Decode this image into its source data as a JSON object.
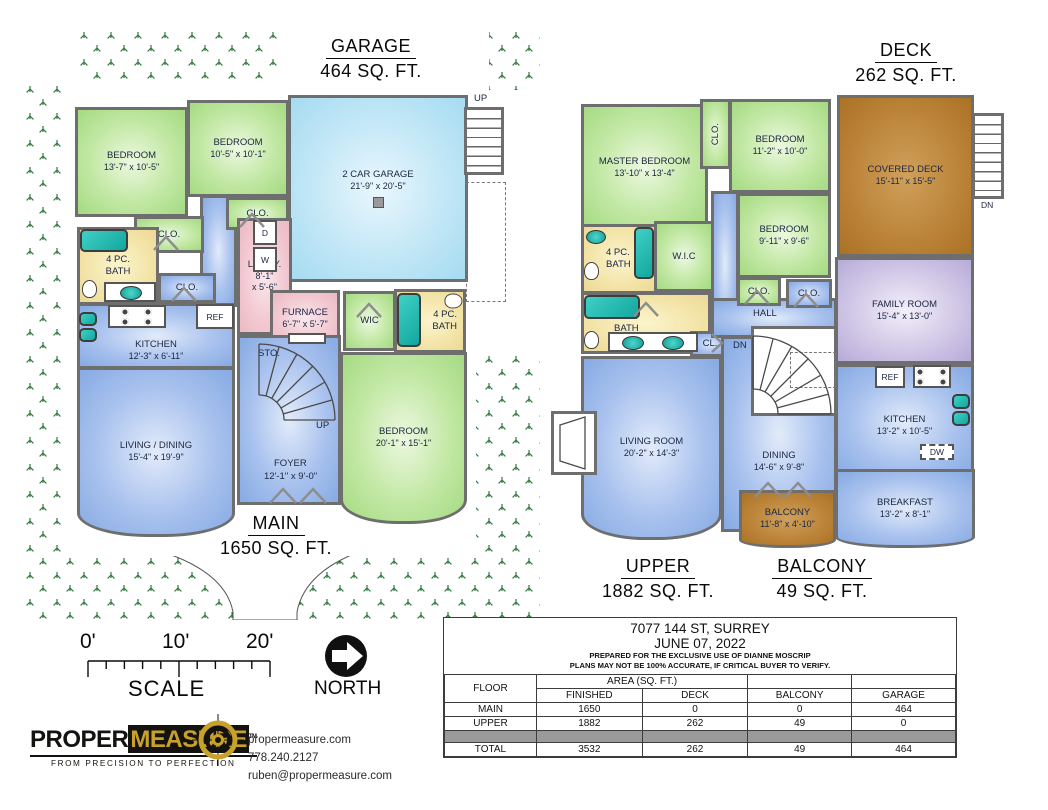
{
  "main_plan": {
    "garage_title": {
      "l1": "GARAGE",
      "l2": "464 SQ. FT."
    },
    "floor_label": {
      "l1": "MAIN",
      "l2": "1650 SQ. FT."
    },
    "rooms": {
      "bedroom1": {
        "name": "BEDROOM",
        "dims": "13'-7\" x 10'-5\""
      },
      "bedroom2": {
        "name": "BEDROOM",
        "dims": "10'-5\" x 10'-1\""
      },
      "garage": {
        "name": "2 CAR GARAGE",
        "dims": "21'-9\" x 20'-5\""
      },
      "kitchen": {
        "name": "KITCHEN",
        "dims": "12'-3\" x 6'-11\""
      },
      "living": {
        "name": "LIVING / DINING",
        "dims": "15'-4\" x 19'-9\""
      },
      "lndry": {
        "name": "LNDRY.",
        "d1": "8'-1\"",
        "d2": "x 5'-6\""
      },
      "furnace": {
        "name": "FURNACE",
        "dims": "6'-7\" x 5'-7\""
      },
      "foyer": {
        "name": "FOYER",
        "dims": "12'-1\" x 9'-0\""
      },
      "bedroom3": {
        "name": "BEDROOM",
        "dims": "20'-1\" x 15'-1\""
      },
      "bath": {
        "l1": "4 PC.",
        "l2": "BATH"
      },
      "clo": "CLO.",
      "wic": "WIC",
      "sto": "STO.",
      "up": "UP",
      "ref": "REF",
      "d": "D",
      "w": "W"
    }
  },
  "upper_plan": {
    "deck_title": {
      "l1": "DECK",
      "l2": "262 SQ. FT."
    },
    "floor_label": {
      "l1": "UPPER",
      "l2": "1882 SQ. FT."
    },
    "balcony_label": {
      "l1": "BALCONY",
      "l2": "49 SQ. FT."
    },
    "rooms": {
      "master": {
        "name": "MASTER BEDROOM",
        "dims": "13'-10\" x 13'-4\""
      },
      "bedroom4": {
        "name": "BEDROOM",
        "dims": "11'-2\" x 10'-0\""
      },
      "bedroom5": {
        "name": "BEDROOM",
        "dims": "9'-11\" x 9'-6\""
      },
      "covered_deck": {
        "name": "COVERED DECK",
        "dims": "15'-11\" x 15'-5\""
      },
      "family": {
        "name": "FAMILY ROOM",
        "dims": "15'-4\" x 13'-0\""
      },
      "kitchen": {
        "name": "KITCHEN",
        "dims": "13'-2\" x 10'-5\""
      },
      "breakfast": {
        "name": "BREAKFAST",
        "dims": "13'-2\" x 8'-1\""
      },
      "living": {
        "name": "LIVING ROOM",
        "dims": "20'-2\" x 14'-3\""
      },
      "dining": {
        "name": "DINING",
        "dims": "14'-6\" x 9'-8\""
      },
      "balcony": {
        "name": "BALCONY",
        "dims": "11'-8\" x 4'-10\""
      },
      "bath4": {
        "l1": "4 PC.",
        "l2": "BATH"
      },
      "bath5": {
        "l1": "5 PC.",
        "l2": "BATH"
      },
      "wic": "W.I.C",
      "hall": "HALL",
      "cl": "CL.",
      "clo": "CLO.",
      "dn": "DN",
      "ref": "REF",
      "dw": "DW"
    }
  },
  "scale_bar": {
    "t0": "0'",
    "t10": "10'",
    "t20": "20'",
    "label": "SCALE"
  },
  "north": {
    "label": "NORTH"
  },
  "logo": {
    "word1": "PROPER",
    "word2": "MEASURE",
    "tm": "TM",
    "tagline": "FROM PRECISION TO PERFECTION"
  },
  "contact": {
    "website": "propermeasure.com",
    "phone": "778.240.2127",
    "email": "ruben@propermeasure.com"
  },
  "info_table": {
    "title1": "7077 144 ST, SURREY",
    "title2": "JUNE 07, 2022",
    "note1": "PREPARED FOR THE EXCLUSIVE USE OF DIANNE MOSCRIP",
    "note2": "PLANS MAY NOT BE 100% ACCURATE, IF CRITICAL BUYER TO VERIFY.",
    "col_floor": "FLOOR",
    "area_header": "AREA (SQ. FT.)",
    "cols": [
      "FINISHED",
      "DECK",
      "BALCONY",
      "GARAGE"
    ],
    "rows": [
      {
        "floor": "MAIN",
        "finished": "1650",
        "deck": "0",
        "balcony": "0",
        "garage": "464"
      },
      {
        "floor": "UPPER",
        "finished": "1882",
        "deck": "262",
        "balcony": "49",
        "garage": "0"
      }
    ],
    "total": {
      "floor": "TOTAL",
      "finished": "3532",
      "deck": "262",
      "balcony": "49",
      "garage": "464"
    }
  },
  "colors": {
    "bedroom_green": "#a4da82",
    "living_blue": "#86aae3",
    "garage_blue": "#a5dbf1",
    "bath_yellow": "#ecd996",
    "utility_pink": "#ecb9c3",
    "family_purple": "#b7abd8",
    "deck_brown": "#ab7226",
    "grass_green": "#2f7a3c",
    "fixture_teal": "#12a79e",
    "wall_grey": "#6e6e6e",
    "logo_gold": "#c7a12c"
  }
}
